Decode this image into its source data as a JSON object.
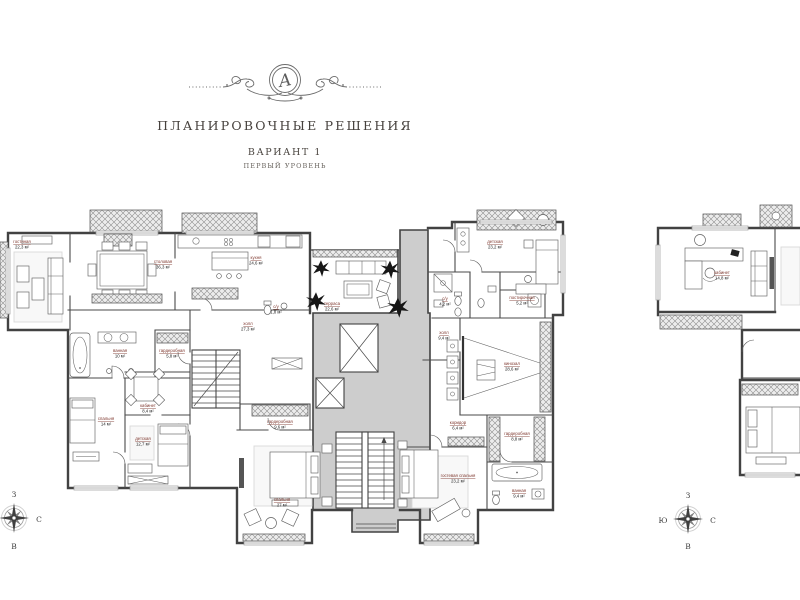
{
  "header": {
    "monogram": "A",
    "title": "ПЛАНИРОВОЧНЫЕ РЕШЕНИЯ",
    "variant": "ВАРИАНТ 1",
    "level": "ПЕРВЫЙ УРОВЕНЬ"
  },
  "colors": {
    "wall": "#424242",
    "common_area": "#cdcdcd",
    "room_name": "#7d352b",
    "area_text": "#1c1c1c",
    "plant": "#161616"
  },
  "plan": {
    "rooms": [
      {
        "name": "гостиная",
        "area": "22,3 м²"
      },
      {
        "name": "столовая",
        "area": "36,3 м²"
      },
      {
        "name": "кухня",
        "area": "24,6 м²"
      },
      {
        "name": "терраса",
        "area": "22,6 м²"
      },
      {
        "name": "детская",
        "area": "23,2 м²"
      },
      {
        "name": "ванная",
        "area": "10 м²"
      },
      {
        "name": "гардеробная",
        "area": "5,8 м²"
      },
      {
        "name": "кабинет",
        "area": "8,4 м²"
      },
      {
        "name": "спальня",
        "area": "14 м²"
      },
      {
        "name": "детская",
        "area": "12,7 м²"
      },
      {
        "name": "холл",
        "area": "27,3 м²"
      },
      {
        "name": "с/у",
        "area": "1,8 м²"
      },
      {
        "name": "гардеробная",
        "area": "9,6 м²"
      },
      {
        "name": "спальня",
        "area": "27 м²"
      },
      {
        "name": "коридор",
        "area": "6,4 м²"
      },
      {
        "name": "гардеробная",
        "area": "8,8 м²"
      },
      {
        "name": "гостевая спальня",
        "area": "23,2 м²"
      },
      {
        "name": "ванная",
        "area": "9,4 м²"
      },
      {
        "name": "кинозал",
        "area": "28,6 м²"
      },
      {
        "name": "с/у",
        "area": "4,2 м²"
      },
      {
        "name": "постирочная",
        "area": "5,2 м²"
      },
      {
        "name": "холл",
        "area": "9,4 м²"
      },
      {
        "name": "кабинет",
        "area": "14,8 м²"
      }
    ]
  },
  "compass": {
    "west": "З",
    "south": "Ю",
    "north": "С",
    "east": "В"
  }
}
